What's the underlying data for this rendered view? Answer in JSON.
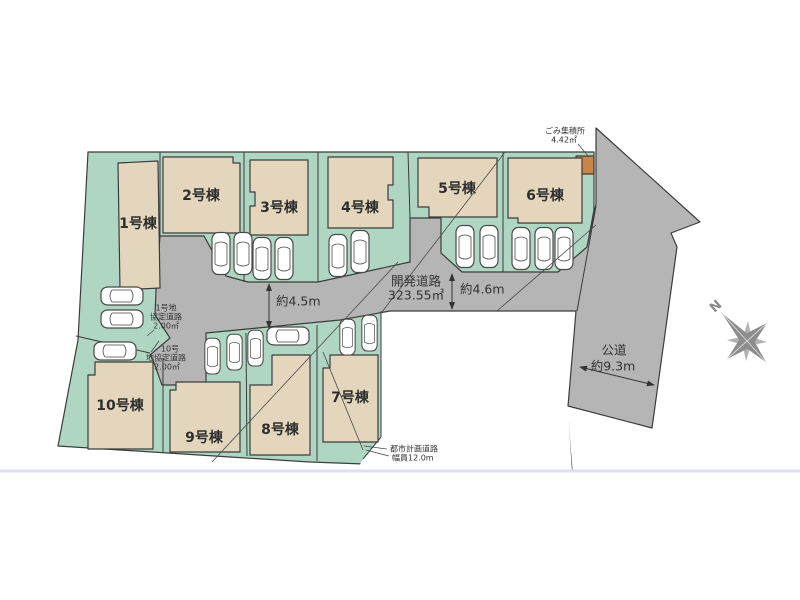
{
  "buildings": [
    {
      "id": "1",
      "label": "1号棟"
    },
    {
      "id": "2",
      "label": "2号棟"
    },
    {
      "id": "3",
      "label": "3号棟"
    },
    {
      "id": "4",
      "label": "4号棟"
    },
    {
      "id": "5",
      "label": "5号棟"
    },
    {
      "id": "6",
      "label": "6号棟"
    },
    {
      "id": "7",
      "label": "7号棟"
    },
    {
      "id": "8",
      "label": "8号棟"
    },
    {
      "id": "9",
      "label": "9号棟"
    },
    {
      "id": "10",
      "label": "10号棟"
    }
  ],
  "roads": {
    "development_road": {
      "name": "開発道路",
      "area": "323.55㎡"
    },
    "width_a": "約4.5m",
    "width_b": "約4.6m",
    "public_road": {
      "name": "公道",
      "width": "約9.3m"
    },
    "agreement_road_1": {
      "line1": "1号地",
      "line2": "協定道路",
      "line3": "2.00㎡"
    },
    "agreement_road_10": {
      "line1": "10号",
      "line2": "地協定道路",
      "line3": "2.00㎡"
    },
    "city_planning_road": {
      "line1": "都市計画道路",
      "line2": "幅員12.0m"
    }
  },
  "garbage_station": {
    "name": "ごみ集積所",
    "area": "4.42㎡"
  },
  "compass": {
    "north_label": "N"
  },
  "colors": {
    "plot_green": "#aed6c3",
    "road_gray": "#b5b5b5",
    "building_tan": "#e3d6bc",
    "garbage_orange": "#c98448",
    "outline": "#3c3c3c",
    "bottom_rule_blue": "#d7e1f0",
    "compass_gray": "#8d8d8d"
  }
}
